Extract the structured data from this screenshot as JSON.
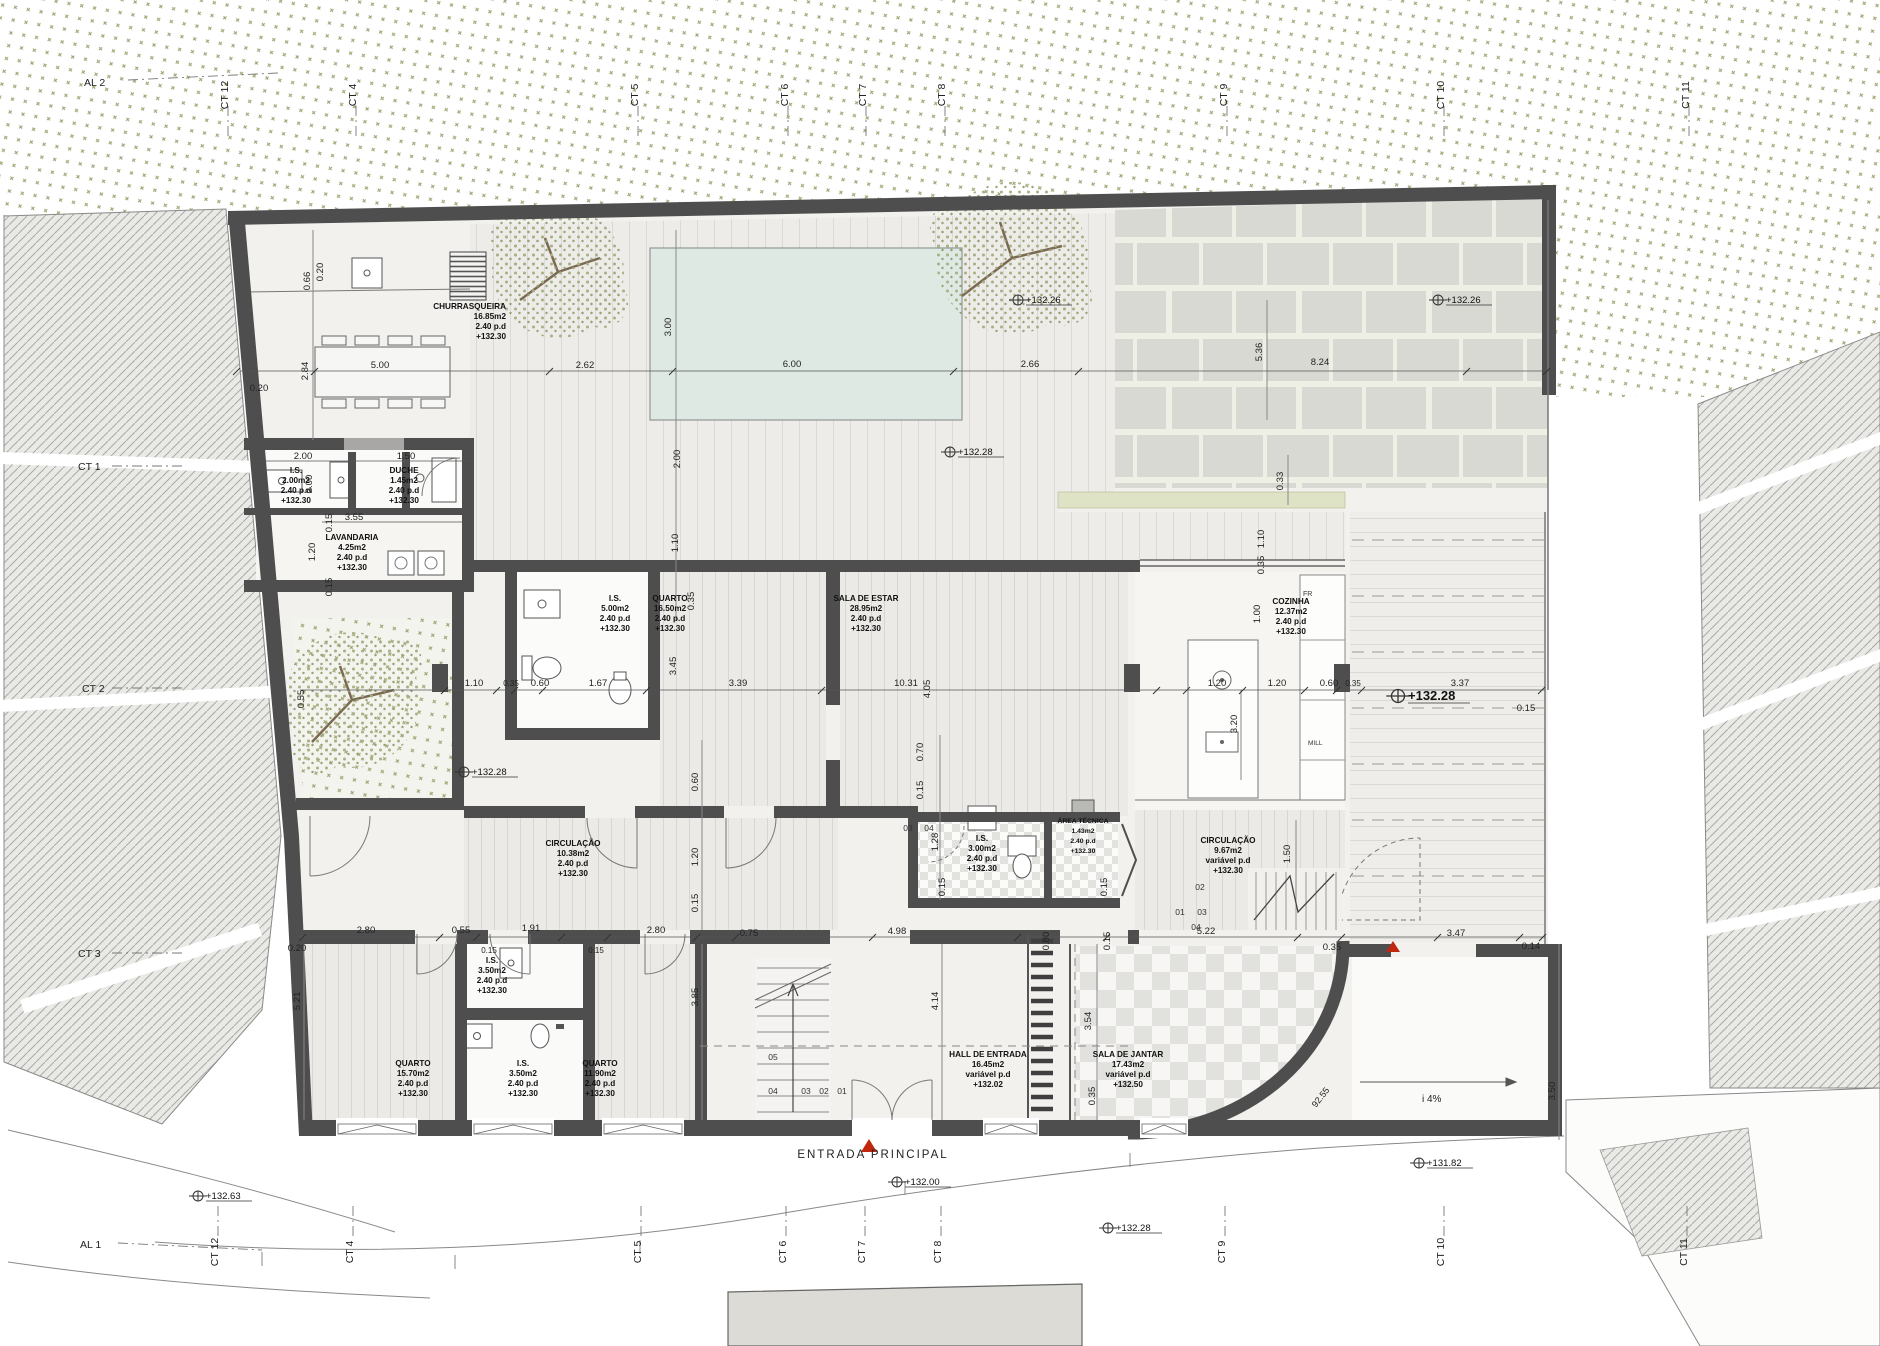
{
  "grid": {
    "top": [
      "AL 2",
      "CT 12",
      "CT 4",
      "CT 5",
      "CT 6",
      "CT 7",
      "CT 8",
      "CT 9",
      "CT 10",
      "CT 11"
    ],
    "left": [
      "CT 1",
      "CT 2",
      "CT 3"
    ],
    "bottom": [
      "AL 1",
      "CT 12",
      "CT 4",
      "CT 5",
      "CT 6",
      "CT 7",
      "CT 8",
      "CT 9",
      "CT 10",
      "CT 11"
    ]
  },
  "rooms": [
    {
      "name": "CHURRASQUEIRA",
      "area": "16.85m2",
      "ceiling": "2.40 p.d",
      "level": "+132.30"
    },
    {
      "name": "I.S.",
      "area": "2.00m2",
      "ceiling": "2.40 p.d",
      "level": "+132.30"
    },
    {
      "name": "DUCHE",
      "area": "1.45m2",
      "ceiling": "2.40 p.d",
      "level": "+132.30"
    },
    {
      "name": "LAVANDARIA",
      "area": "4.25m2",
      "ceiling": "2.40 p.d",
      "level": "+132.30"
    },
    {
      "name": "I.S.",
      "area": "5.00m2",
      "ceiling": "2.40 p.d",
      "level": "+132.30"
    },
    {
      "name": "QUARTO",
      "area": "16.50m2",
      "ceiling": "2.40 p.d",
      "level": "+132.30"
    },
    {
      "name": "SALA DE ESTAR",
      "area": "28.95m2",
      "ceiling": "2.40 p.d",
      "level": "+132.30"
    },
    {
      "name": "COZINHA",
      "area": "12.37m2",
      "ceiling": "2.40 p.d",
      "level": "+132.30"
    },
    {
      "name": "CIRCULAÇÃO",
      "area": "10.38m2",
      "ceiling": "2.40 p.d",
      "level": "+132.30"
    },
    {
      "name": "I.S.",
      "area": "3.00m2",
      "ceiling": "2.40 p.d",
      "level": "+132.30"
    },
    {
      "name": "ÁREA TÉCNICA",
      "area": "1.43m2",
      "ceiling": "2.40 p.d",
      "level": "+132.30"
    },
    {
      "name": "CIRCULAÇÃO",
      "area": "9.67m2",
      "ceiling": "variável p.d",
      "level": "+132.30"
    },
    {
      "name": "QUARTO",
      "area": "15.70m2",
      "ceiling": "2.40 p.d",
      "level": "+132.30"
    },
    {
      "name": "I.S.",
      "area": "3.50m2",
      "ceiling": "2.40 p.d",
      "level": "+132.30"
    },
    {
      "name": "I.S.",
      "area": "3.50m2",
      "ceiling": "2.40 p.d",
      "level": "+132.30"
    },
    {
      "name": "QUARTO",
      "area": "11.90m2",
      "ceiling": "2.40 p.d",
      "level": "+132.30"
    },
    {
      "name": "HALL DE ENTRADA",
      "area": "16.45m2",
      "ceiling": "variável p.d",
      "level": "+132.02"
    },
    {
      "name": "SALA DE JANTAR",
      "area": "17.43m2",
      "ceiling": "variável p.d",
      "level": "+132.50"
    }
  ],
  "levels": [
    "+132.26",
    "+132.26",
    "+132.28",
    "+132.28",
    "+132.28",
    "+132.00",
    "+132.28",
    "+131.82",
    "+132.63"
  ],
  "dims": [
    "0.66",
    "0.20",
    "0.20",
    "2.84",
    "5.00",
    "2.62",
    "6.00",
    "2.66",
    "8.24",
    "3.00",
    "5.36",
    "0.33",
    "2.00",
    "1.50",
    "3.55",
    "0.15",
    "1.20",
    "0.15",
    "2.00",
    "1.10",
    "0.35",
    "2.00",
    "1.10",
    "0.35",
    "1.00",
    "1.10",
    "0.35",
    "0.60",
    "1.67",
    "3.45",
    "3.39",
    "10.31",
    "4.05",
    "1.20",
    "1.20",
    "0.60",
    "0.35",
    "3.37",
    "0.15",
    "0.55",
    "3.20",
    "0.60",
    "1.20",
    "0.15",
    "0.70",
    "0.15",
    "1.28",
    "0.15",
    "0.15",
    "1.50",
    "0.20",
    "2.80",
    "0.55",
    "1.91",
    "0.15",
    "0.15",
    "2.80",
    "0.75",
    "4.98",
    "0.80",
    "0.15",
    "5.22",
    "0.35",
    "3.47",
    "0.14",
    "5.21",
    "3.85",
    "4.14",
    "3.54",
    "0.35",
    "3.50"
  ],
  "refs": [
    "03",
    "04",
    "02",
    "01",
    "03",
    "04",
    "05",
    "04",
    "03",
    "02",
    "01"
  ],
  "misc": {
    "entrance": "ENTRADA PRINCIPAL",
    "fridge": "FR",
    "appliance": "MILL",
    "ramp_slope": "i 4%",
    "ramp_length": "92.55"
  }
}
